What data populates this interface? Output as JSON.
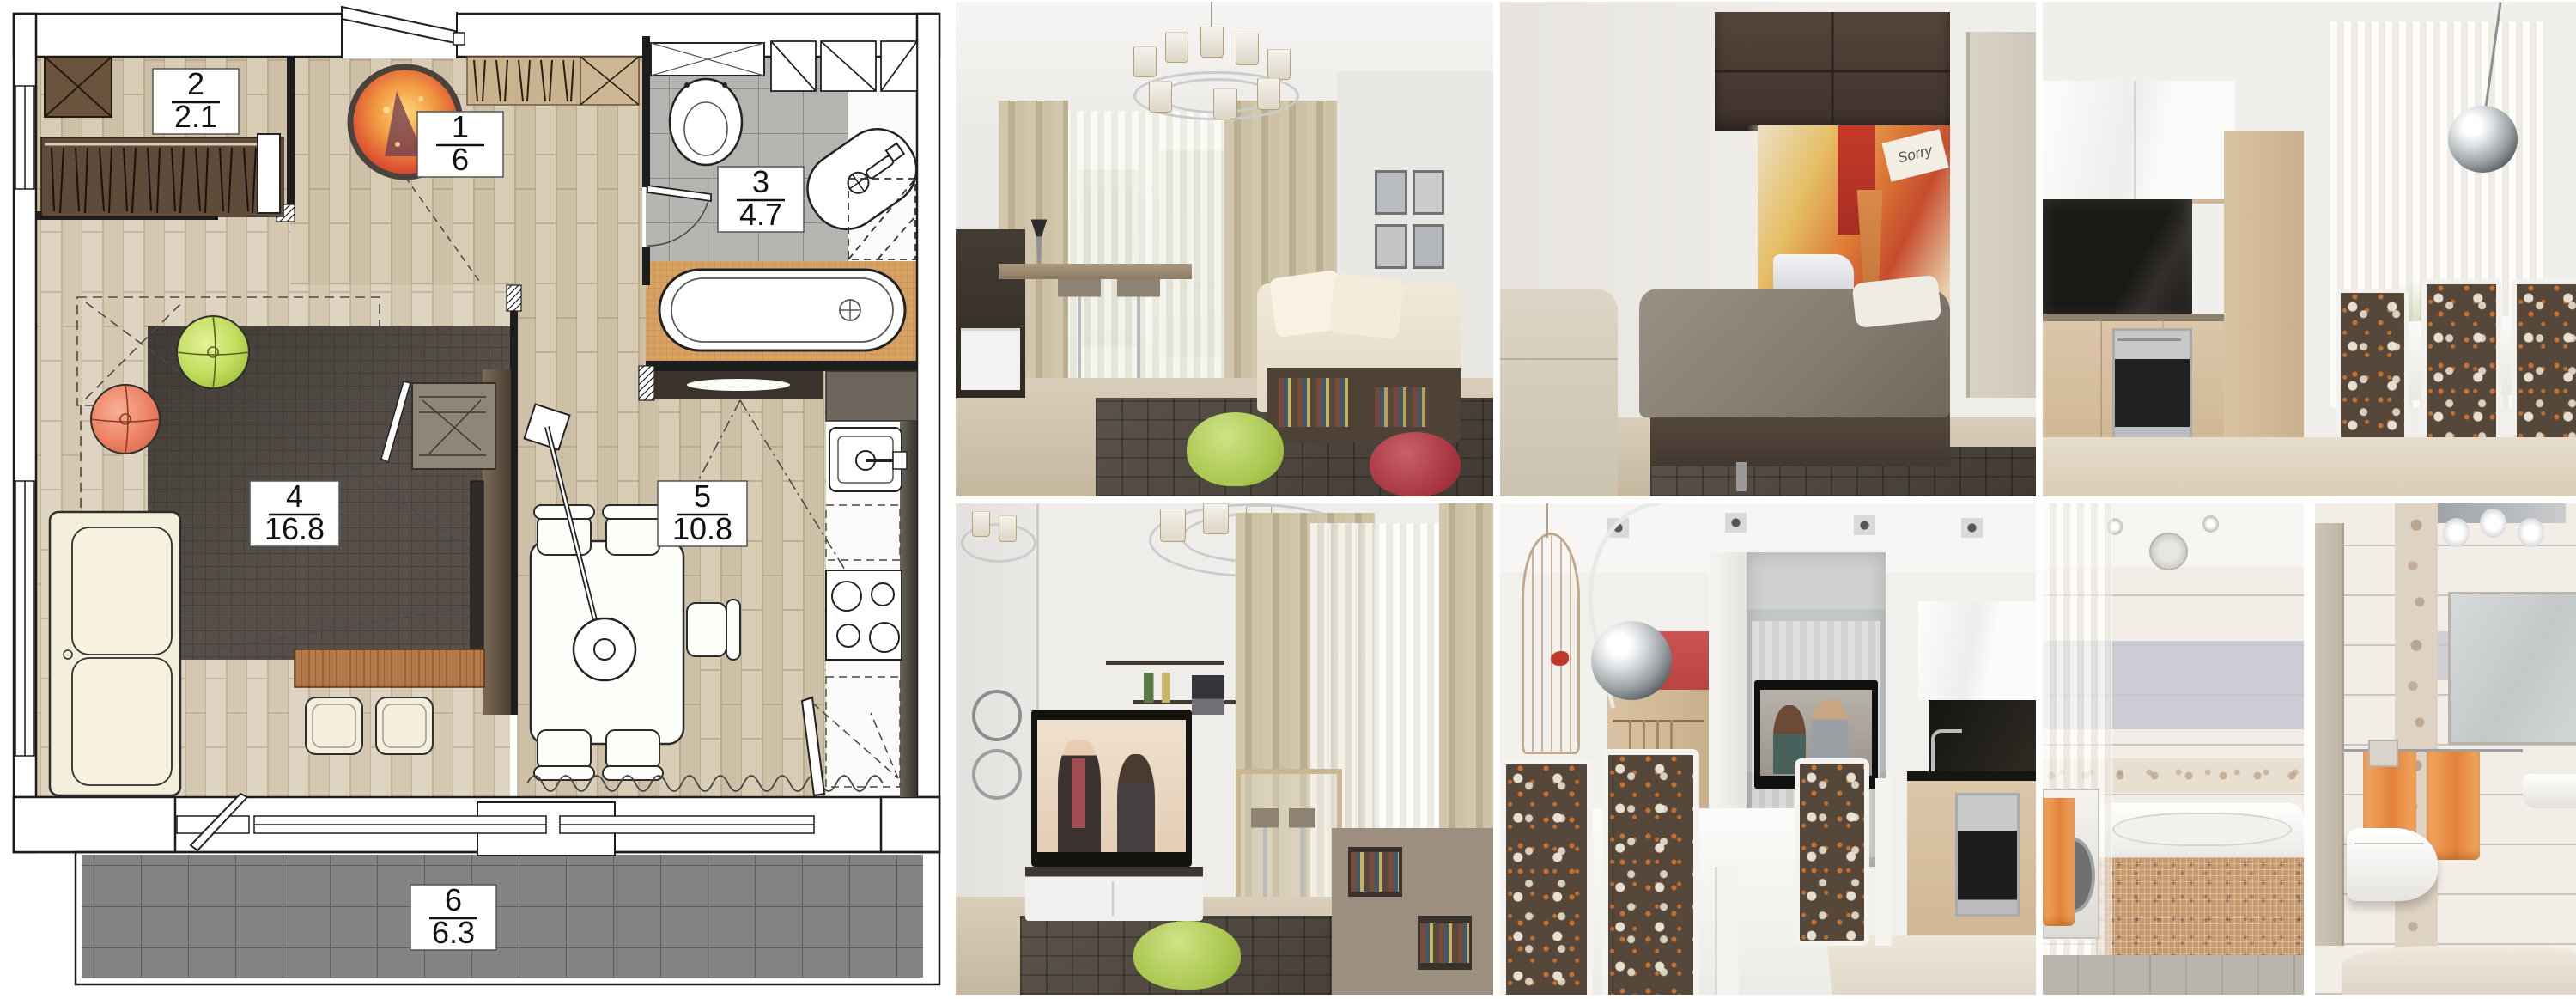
{
  "plan": {
    "rooms": [
      {
        "name": "hall",
        "number": "1",
        "area": "6"
      },
      {
        "name": "closet",
        "number": "2",
        "area": "2.1"
      },
      {
        "name": "bathroom",
        "number": "3",
        "area": "4.7"
      },
      {
        "name": "living-room",
        "number": "4",
        "area": "16.8"
      },
      {
        "name": "kitchen",
        "number": "5",
        "area": "10.8"
      },
      {
        "name": "balcony",
        "number": "6",
        "area": "6.3"
      }
    ],
    "palette": {
      "floor_wood": "#d8ccb5",
      "living_rug": "#57504a",
      "bath_tile": "#b6b4b0",
      "balcony_tile": "#828282",
      "tub_mosaic": "#d8a263",
      "pouf_green": "#c3dd60",
      "pouf_red": "#ee8568",
      "round_rug_orange": "#f29a43",
      "sofa_cream": "#f4efdb"
    }
  },
  "photos": [
    {
      "name": "living-room-window",
      "subject": "living room with chandelier, beige curtains, cream sofa, green and red poufs"
    },
    {
      "name": "bedroom-murphy-bed",
      "subject": "fold-down bed under brown cabinets with pop-art city mural"
    },
    {
      "name": "kitchen-cabinets",
      "subject": "light wood kitchen, black TV panel, oven, dining chairs with floral backs"
    },
    {
      "name": "living-room-tv",
      "subject": "TV showing a couple, white media stand, wall shelves, green pouf"
    },
    {
      "name": "dining-area",
      "subject": "white dining table, floral chairs, arc lamp, red accent niche, TV"
    },
    {
      "name": "bathroom-views",
      "subject": "bathtub with mosaic front, wall-hung toilet, orange towels"
    }
  ],
  "mural_text": "Sorry"
}
